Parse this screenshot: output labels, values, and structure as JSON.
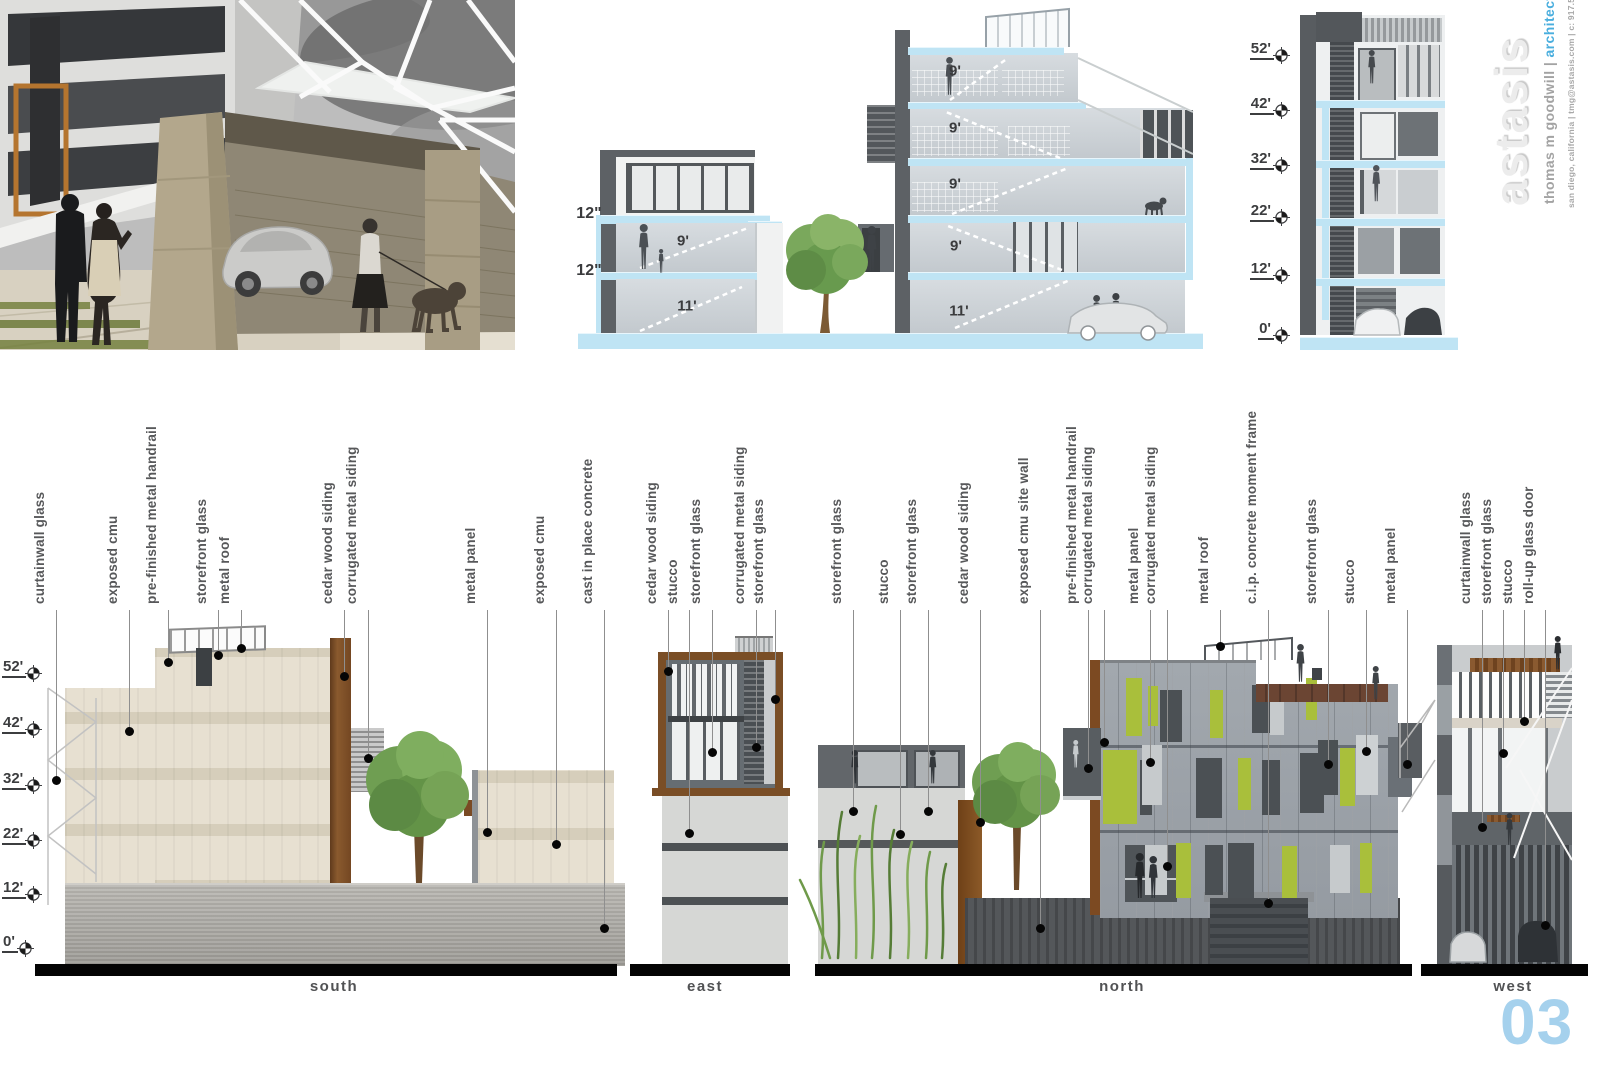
{
  "board": {
    "page_number": "03",
    "accent_blue": "#a5d1ed"
  },
  "brand": {
    "logo": "astasis",
    "credit_name": "thomas m goodwill ",
    "credit_divider": "| ",
    "credit_role": "architect",
    "contact": "san diego, california | tmg@astasis.com | c: 917.570.8947"
  },
  "section_drawings": {
    "slab_labels": [
      {
        "text": "12\"",
        "x": 589,
        "y": 214
      },
      {
        "text": "12\"",
        "x": 589,
        "y": 271
      }
    ],
    "floor_heights": [
      {
        "text": "9'",
        "x": 683,
        "y": 241
      },
      {
        "text": "11'",
        "x": 687,
        "y": 306
      },
      {
        "text": "9'",
        "x": 955,
        "y": 71
      },
      {
        "text": "9'",
        "x": 955,
        "y": 128
      },
      {
        "text": "9'",
        "x": 955,
        "y": 184
      },
      {
        "text": "9'",
        "x": 956,
        "y": 246
      },
      {
        "text": "11'",
        "x": 959,
        "y": 311
      }
    ],
    "level_markers": [
      {
        "text": "52'",
        "y": 52
      },
      {
        "text": "42'",
        "y": 107
      },
      {
        "text": "32'",
        "y": 162
      },
      {
        "text": "22'",
        "y": 214
      },
      {
        "text": "12'",
        "y": 272
      },
      {
        "text": "0'",
        "y": 332
      }
    ]
  },
  "elevation_sheet": {
    "callout_line_top": 610,
    "level_markers": [
      {
        "text": "52'",
        "y": 670
      },
      {
        "text": "42'",
        "y": 726
      },
      {
        "text": "32'",
        "y": 782
      },
      {
        "text": "22'",
        "y": 837
      },
      {
        "text": "12'",
        "y": 891
      },
      {
        "text": "0'",
        "y": 945
      }
    ],
    "elevations": [
      {
        "title": "south",
        "title_x": 334,
        "bar": {
          "x": 35,
          "w": 582
        },
        "callouts": [
          {
            "label": "curtainwall glass",
            "x": 56,
            "dot_y": 780
          },
          {
            "label": "exposed cmu",
            "x": 129,
            "dot_y": 731
          },
          {
            "label": "pre-finished metal handrail",
            "x": 168,
            "dot_y": 662
          },
          {
            "label": "storefront glass",
            "x": 218,
            "dot_y": 655
          },
          {
            "label": "metal roof",
            "x": 241,
            "dot_y": 648
          },
          {
            "label": "cedar wood siding",
            "x": 344,
            "dot_y": 676
          },
          {
            "label": "corrugated metal siding",
            "x": 368,
            "dot_y": 758
          },
          {
            "label": "metal panel",
            "x": 487,
            "dot_y": 832
          },
          {
            "label": "exposed cmu",
            "x": 556,
            "dot_y": 844
          },
          {
            "label": "cast in place concrete",
            "x": 604,
            "dot_y": 928
          }
        ]
      },
      {
        "title": "east",
        "title_x": 705,
        "bar": {
          "x": 630,
          "w": 160
        },
        "callouts": [
          {
            "label": "cedar wood siding",
            "x": 668,
            "dot_y": 671
          },
          {
            "label": "stucco",
            "x": 689,
            "dot_y": 833
          },
          {
            "label": "storefront glass",
            "x": 712,
            "dot_y": 752
          },
          {
            "label": "corrugated metal siding",
            "x": 756,
            "dot_y": 747
          },
          {
            "label": "storefront glass",
            "x": 775,
            "dot_y": 699
          }
        ]
      },
      {
        "title": "north",
        "title_x": 1122,
        "bar": {
          "x": 815,
          "w": 597
        },
        "callouts": [
          {
            "label": "storefront glass",
            "x": 853,
            "dot_y": 811
          },
          {
            "label": "stucco",
            "x": 900,
            "dot_y": 834
          },
          {
            "label": "storefront glass",
            "x": 928,
            "dot_y": 811
          },
          {
            "label": "cedar wood siding",
            "x": 980,
            "dot_y": 822
          },
          {
            "label": "exposed cmu site wall",
            "x": 1040,
            "dot_y": 928
          },
          {
            "label": "pre-finished metal handrail",
            "x": 1088,
            "dot_y": 768
          },
          {
            "label": "corrugated metal siding",
            "x": 1104,
            "dot_y": 742
          },
          {
            "label": "metal panel",
            "x": 1150,
            "dot_y": 762
          },
          {
            "label": "corrugated metal siding",
            "x": 1167,
            "dot_y": 866
          },
          {
            "label": "metal roof",
            "x": 1220,
            "dot_y": 646
          },
          {
            "label": "c.i.p. concrete moment frame",
            "x": 1268,
            "dot_y": 903
          },
          {
            "label": "storefront glass",
            "x": 1328,
            "dot_y": 764
          },
          {
            "label": "stucco",
            "x": 1366,
            "dot_y": 751
          },
          {
            "label": "metal panel",
            "x": 1407,
            "dot_y": 764
          }
        ]
      },
      {
        "title": "west",
        "title_x": 1513,
        "bar": {
          "x": 1421,
          "w": 167
        },
        "callouts": [
          {
            "label": "curtainwall glass",
            "x": 1482,
            "dot_y": 827
          },
          {
            "label": "storefront glass",
            "x": 1503,
            "dot_y": 753
          },
          {
            "label": "stucco",
            "x": 1524,
            "dot_y": 721
          },
          {
            "label": "roll-up glass door",
            "x": 1545,
            "dot_y": 925
          }
        ]
      }
    ]
  }
}
